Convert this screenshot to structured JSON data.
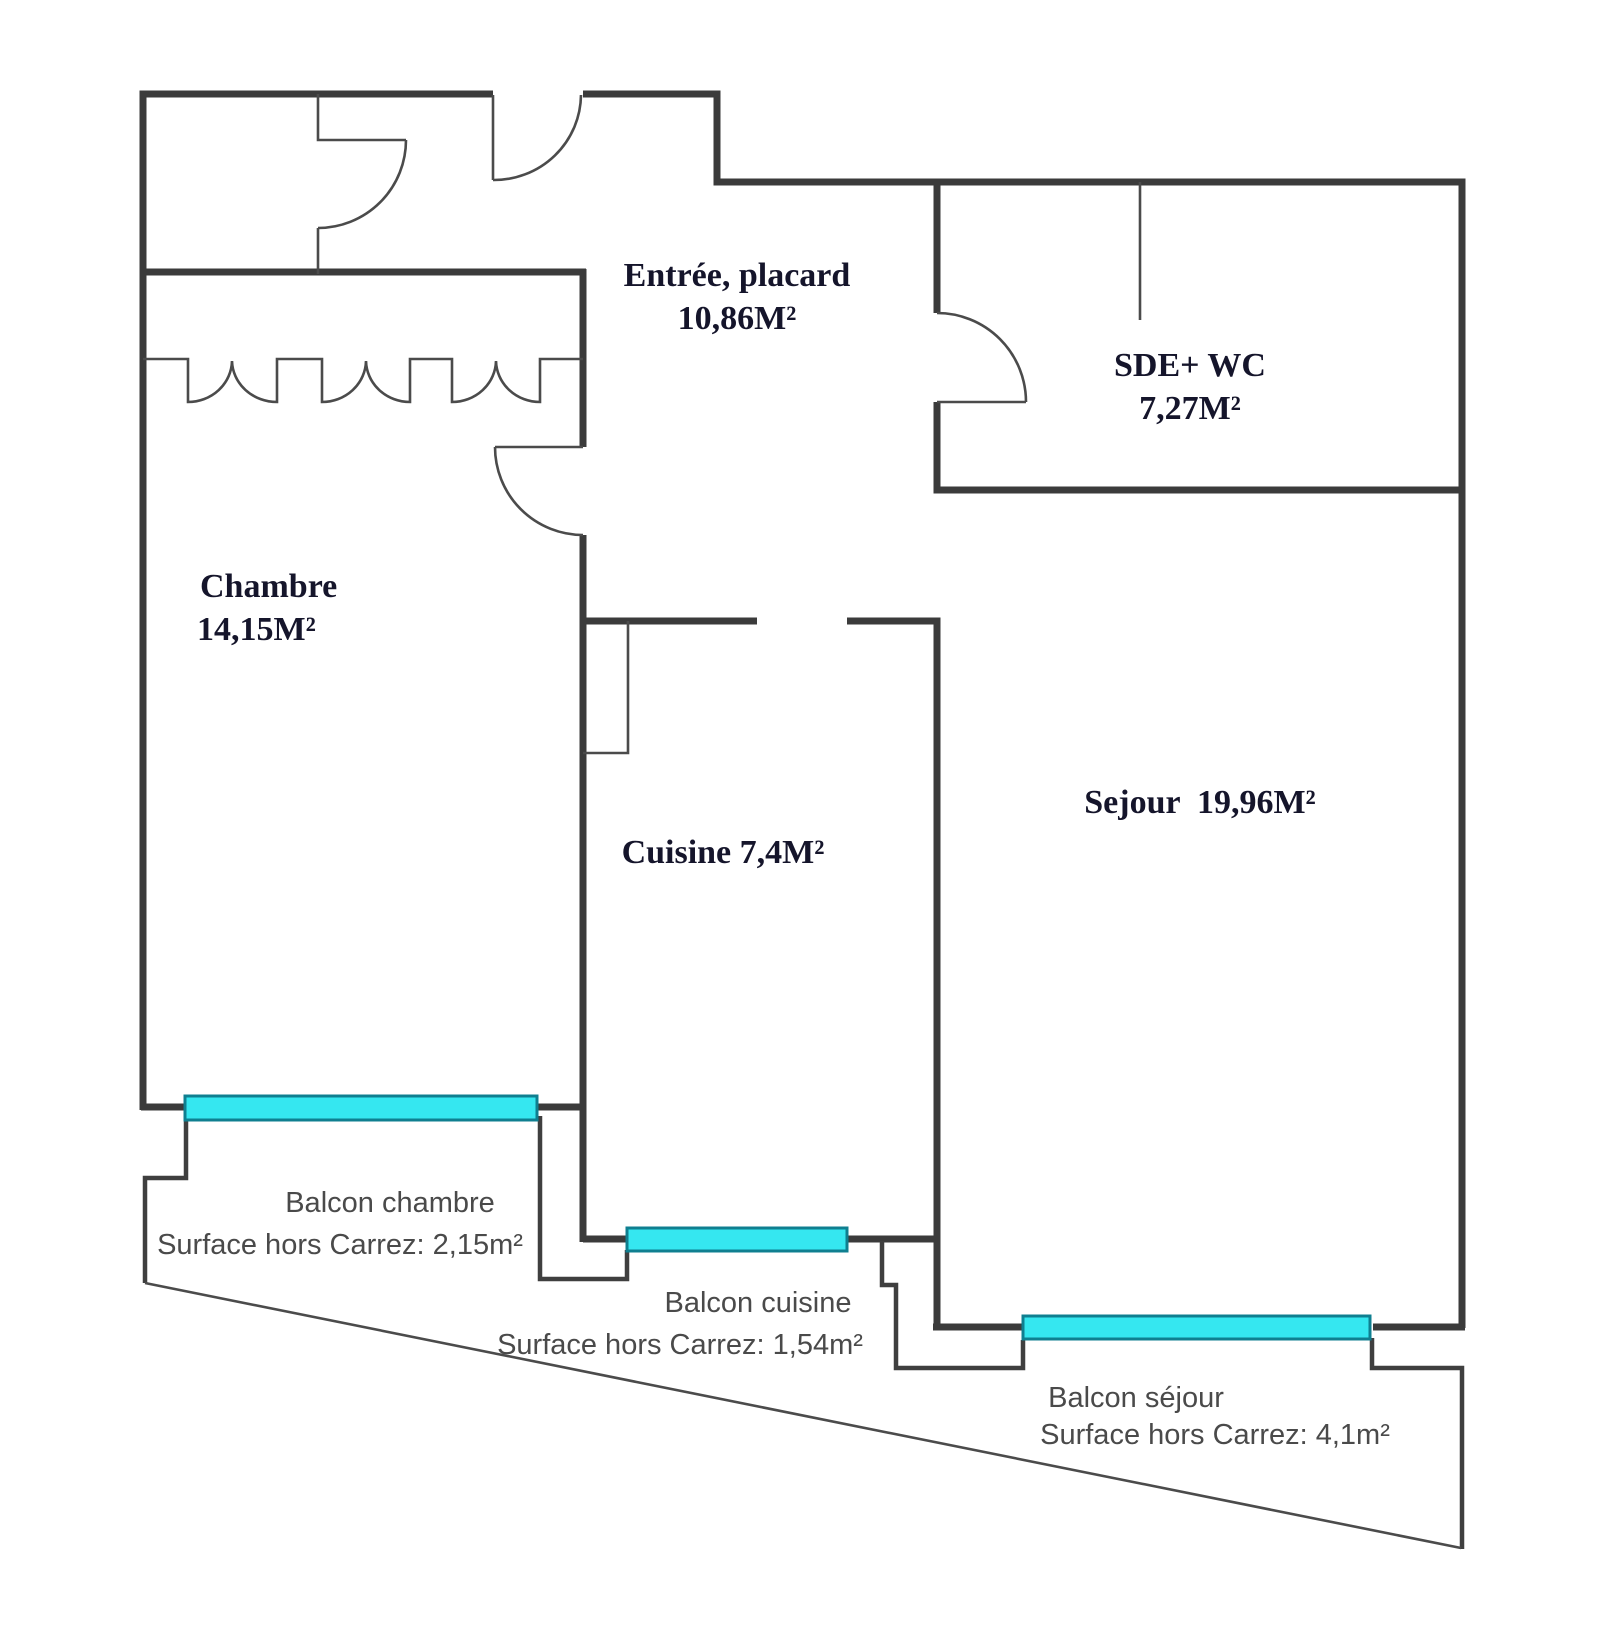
{
  "plan": {
    "type": "apartment-floor-plan",
    "rooms": {
      "entree": {
        "label": "Entrée, placard",
        "area": "10,86M²"
      },
      "sde": {
        "label": "SDE+ WC",
        "area": "7,27M²"
      },
      "chambre": {
        "label": "Chambre",
        "area": "14,15M²"
      },
      "cuisine": {
        "line": "Cuisine 7,4M²"
      },
      "sejour": {
        "line": "Sejour  19,96M²"
      }
    },
    "balconies": {
      "chambre": {
        "label": "Balcon chambre",
        "surface": "Surface hors Carrez: 2,15m²"
      },
      "cuisine": {
        "label": "Balcon cuisine",
        "surface": "Surface hors Carrez: 1,54m²"
      },
      "sejour": {
        "label": "Balcon séjour",
        "surface": "Surface hors Carrez: 4,1m²"
      }
    },
    "colors": {
      "wall": "#3b3b3b",
      "window_fill": "#35e7f0",
      "window_stroke": "#0f7f90",
      "room_label": "#15152b",
      "balcony_label": "#4a4a4a",
      "background": "#ffffff"
    }
  }
}
